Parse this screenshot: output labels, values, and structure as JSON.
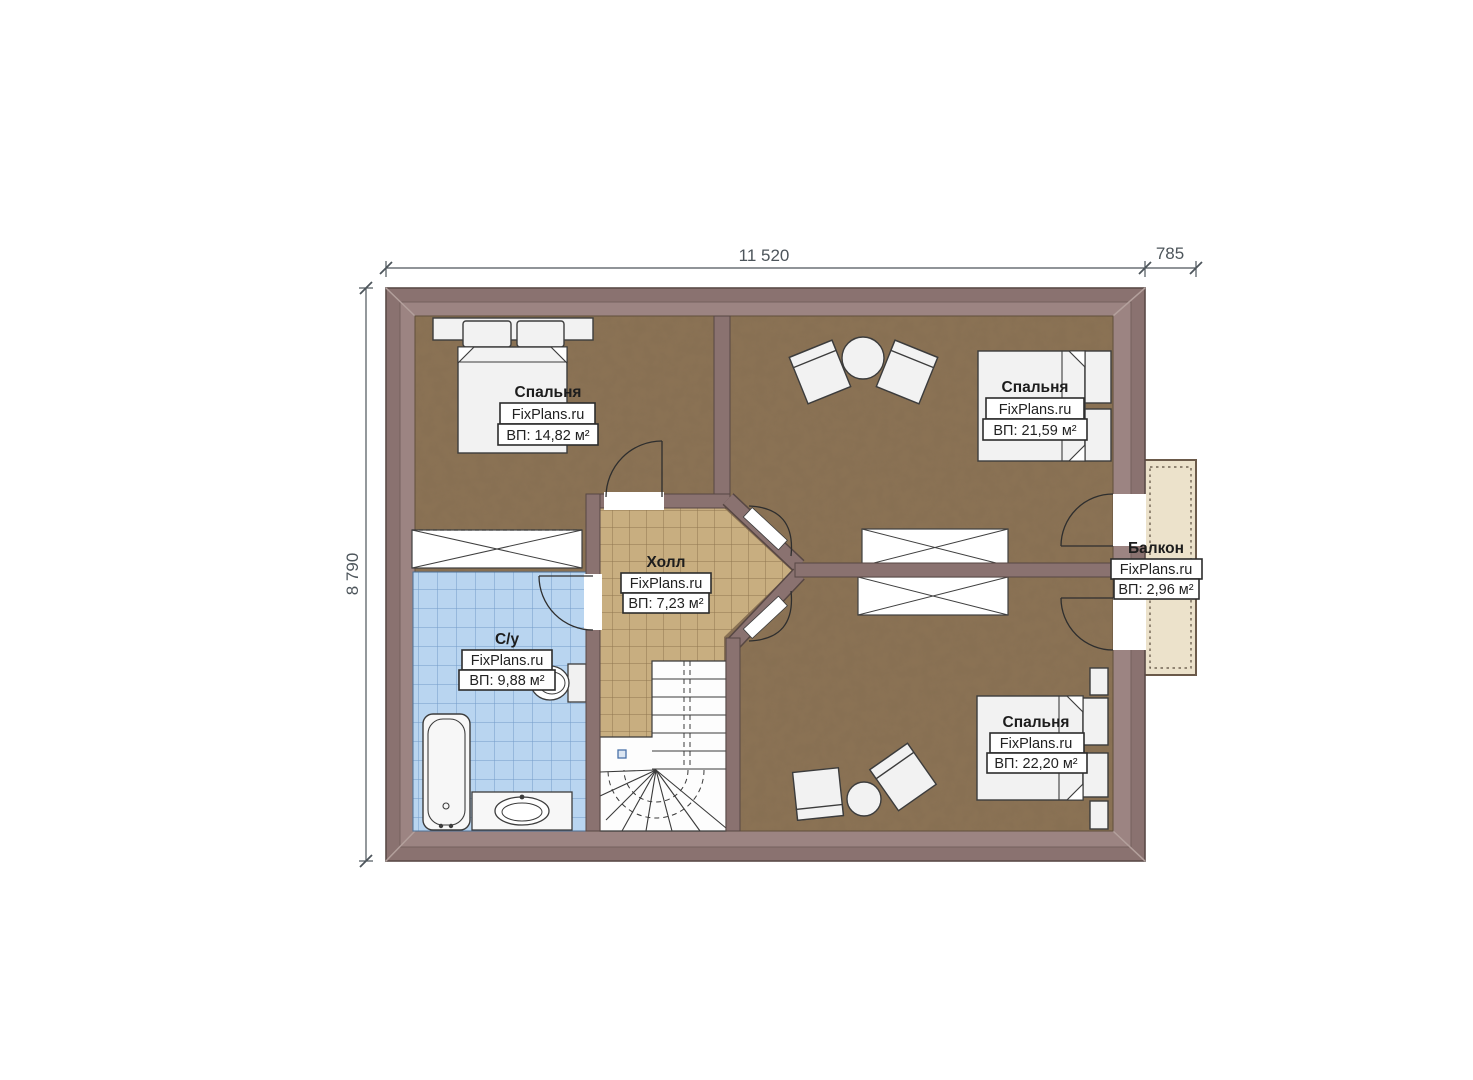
{
  "dimensions": {
    "top_width": "11 520",
    "top_balcony": "785",
    "left_height": "8 790"
  },
  "rooms": {
    "bedroom_top_left": {
      "name": "Спальня",
      "watermark": "FixPlans.ru",
      "area": "ВП: 14,82 м²"
    },
    "bedroom_top_right": {
      "name": "Спальня",
      "watermark": "FixPlans.ru",
      "area": "ВП: 21,59 м²"
    },
    "bedroom_bottom_right": {
      "name": "Спальня",
      "watermark": "FixPlans.ru",
      "area": "ВП: 22,20 м²"
    },
    "hall": {
      "name": "Холл",
      "watermark": "FixPlans.ru",
      "area": "ВП: 7,23 м²"
    },
    "bathroom": {
      "name": "С/у",
      "watermark": "FixPlans.ru",
      "area": "ВП: 9,88 м²"
    },
    "balcony": {
      "name": "Балкон",
      "watermark": "FixPlans.ru",
      "area": "ВП: 2,96 м²"
    }
  },
  "colors": {
    "wall": "#8a7270",
    "wall_inner": "#9c8482",
    "floor_wood": "#8c7355",
    "tile_hall": "#c8ae80",
    "tile_bath": "#b9d5f0",
    "balcony_floor": "#ece2cb",
    "dimension": "#4d555b"
  }
}
